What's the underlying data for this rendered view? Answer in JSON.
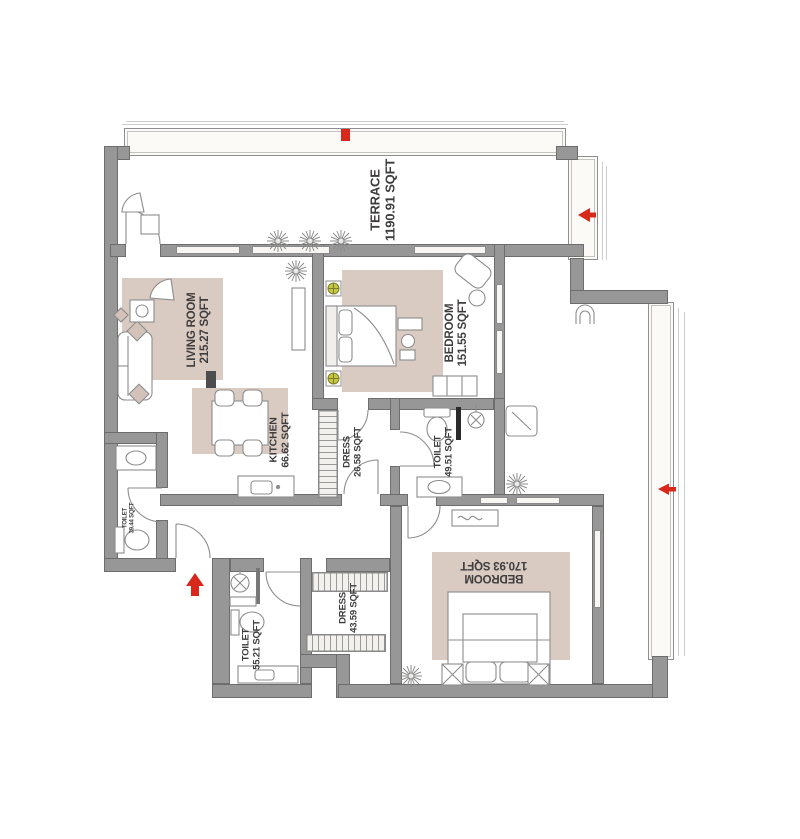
{
  "plan_type": "apartment floor plan",
  "rooms": [
    {
      "id": "terrace",
      "name": "TERRACE",
      "area": "1190.91 SQFT"
    },
    {
      "id": "living-room",
      "name": "LIVING ROOM",
      "area": "215.27 SQFT"
    },
    {
      "id": "bedroom-top",
      "name": "BEDROOM",
      "area": "151.55 SQFT"
    },
    {
      "id": "kitchen",
      "name": "KITCHEN",
      "area": "66.62 SQFT"
    },
    {
      "id": "dress-top",
      "name": "DRESS",
      "area": "26.58 SQFT"
    },
    {
      "id": "toilet-top",
      "name": "TOILET",
      "area": "49.51 SQFT"
    },
    {
      "id": "toilet-left",
      "name": "TOILET",
      "area": "39.44 SQFT"
    },
    {
      "id": "toilet-bottom",
      "name": "TOILET",
      "area": "55.21 SQFT"
    },
    {
      "id": "dress-bottom",
      "name": "DRESS",
      "area": "43.59 SQFT"
    },
    {
      "id": "bedroom-bottom",
      "name": "BEDROOM",
      "area": "170.93 SQFT"
    }
  ],
  "icons": {
    "entry_arrow": "red arrow pointing up at main entrance",
    "window_markers": "red direction markers on windows",
    "plants": "potted plant symbols",
    "ceiling_lights": "yellow-green light fixtures in top bedroom"
  },
  "colors": {
    "wall": "#979797",
    "rug_beige": "#d9cac2",
    "accent_red": "#d8271b",
    "light_fixture": "#c6c93f",
    "label_text": "#3e3c3d"
  }
}
